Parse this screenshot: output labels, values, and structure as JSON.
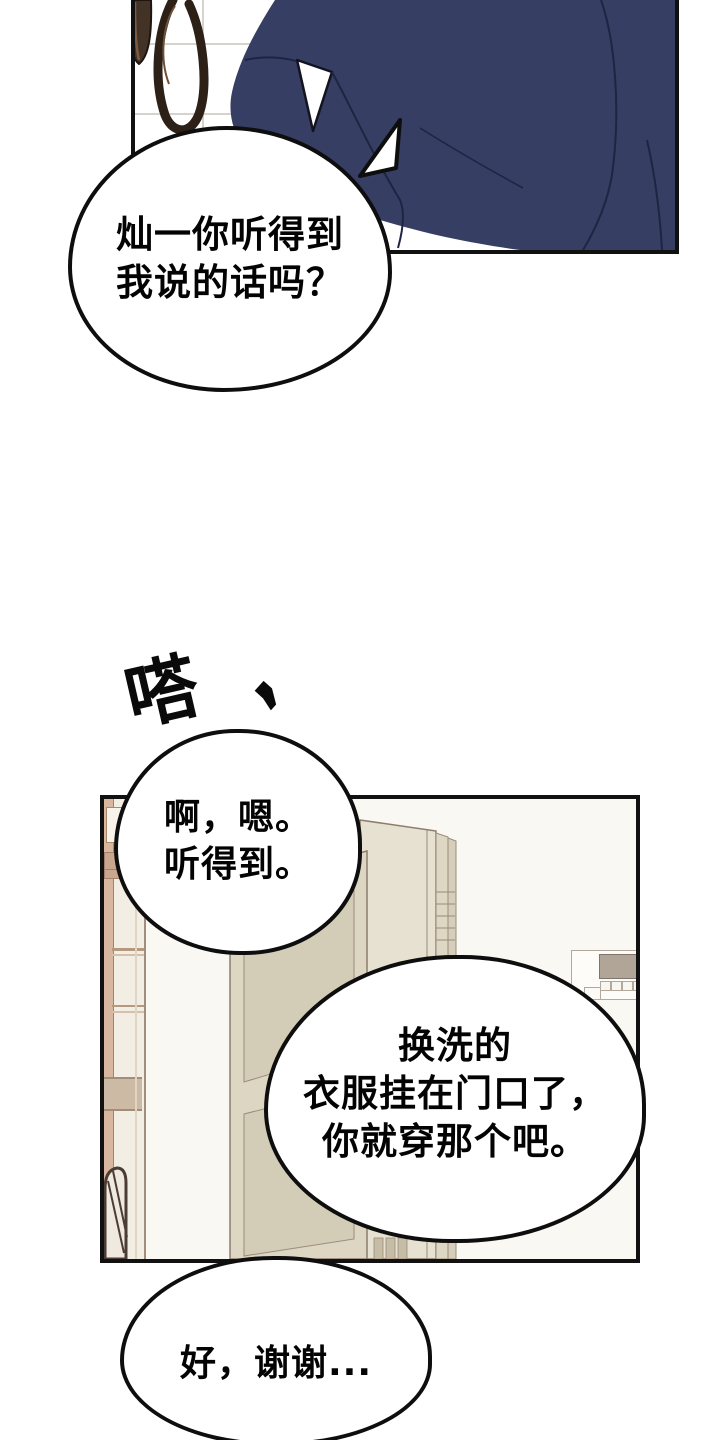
{
  "comic": {
    "sfx": {
      "text": "嗒",
      "mark": ","
    },
    "bubbles": {
      "b1": {
        "line1": "灿一你听得到",
        "line2": "我说的话吗？"
      },
      "b2": {
        "line1": "啊，嗯。",
        "line2": "听得到。"
      },
      "b3": {
        "line1": "换洗的",
        "line2": "衣服挂在门口了，",
        "line3": "你就穿那个吧。"
      },
      "b4": {
        "line1": "好，谢谢..."
      }
    },
    "colors": {
      "shirt_navy": "#363e63",
      "panel_border": "#111111",
      "door_front": "#dcd6c3",
      "door_back": "#e6e1d0",
      "wall_cream": "#faf8f3",
      "cabinet_wood": "#c9a68d",
      "tan_block": "#cdbaa5",
      "tile_grout": "#d6d3cc",
      "hose_dark": "#3a2c21",
      "intercom_screen": "#b1a597"
    }
  }
}
